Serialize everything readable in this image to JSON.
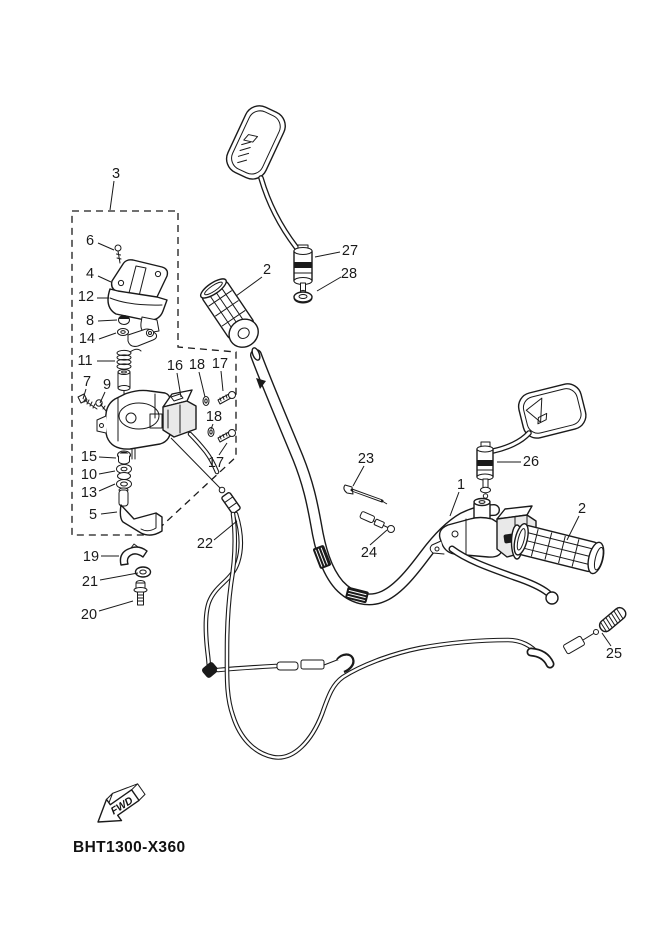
{
  "diagram": {
    "part_code": "BHT1300-X360",
    "fwd_label": "FWD",
    "background": "#ffffff",
    "line_color": "#1a1a1a",
    "callouts": [
      {
        "n": "3",
        "x": 116,
        "y": 178,
        "lx1": 114,
        "ly1": 181,
        "lx2": 110,
        "ly2": 210
      },
      {
        "n": "6",
        "x": 90,
        "y": 245,
        "lx1": 98,
        "ly1": 243,
        "lx2": 114,
        "ly2": 250
      },
      {
        "n": "4",
        "x": 90,
        "y": 278,
        "lx1": 98,
        "ly1": 276,
        "lx2": 111,
        "ly2": 282
      },
      {
        "n": "12",
        "x": 86,
        "y": 301,
        "lx1": 97,
        "ly1": 298,
        "lx2": 109,
        "ly2": 298
      },
      {
        "n": "8",
        "x": 90,
        "y": 325,
        "lx1": 98,
        "ly1": 321,
        "lx2": 117,
        "ly2": 320
      },
      {
        "n": "14",
        "x": 87,
        "y": 343,
        "lx1": 99,
        "ly1": 339,
        "lx2": 116,
        "ly2": 333
      },
      {
        "n": "11",
        "x": 85,
        "y": 365,
        "lx1": 97,
        "ly1": 361,
        "lx2": 115,
        "ly2": 361
      },
      {
        "n": "7",
        "x": 87,
        "y": 386,
        "lx1": 86,
        "ly1": 389,
        "lx2": 83,
        "ly2": 399
      },
      {
        "n": "9",
        "x": 107,
        "y": 389,
        "lx1": 105,
        "ly1": 392,
        "lx2": 100,
        "ly2": 403
      },
      {
        "n": "16",
        "x": 175,
        "y": 370,
        "lx1": 177,
        "ly1": 373,
        "lx2": 181,
        "ly2": 397
      },
      {
        "n": "18",
        "x": 197,
        "y": 369,
        "lx1": 199,
        "ly1": 372,
        "lx2": 205,
        "ly2": 397
      },
      {
        "n": "17",
        "x": 220,
        "y": 368,
        "lx1": 221,
        "ly1": 371,
        "lx2": 223,
        "ly2": 391
      },
      {
        "n": "18",
        "x": 214,
        "y": 421,
        "lx1": 213,
        "ly1": 424,
        "lx2": 211,
        "ly2": 429
      },
      {
        "n": "17",
        "x": 216,
        "y": 467,
        "lx1": 219,
        "ly1": 455,
        "lx2": 227,
        "ly2": 443
      },
      {
        "n": "15",
        "x": 89,
        "y": 461,
        "lx1": 99,
        "ly1": 457,
        "lx2": 116,
        "ly2": 458
      },
      {
        "n": "10",
        "x": 89,
        "y": 479,
        "lx1": 99,
        "ly1": 474,
        "lx2": 115,
        "ly2": 471
      },
      {
        "n": "13",
        "x": 89,
        "y": 497,
        "lx1": 99,
        "ly1": 491,
        "lx2": 115,
        "ly2": 484
      },
      {
        "n": "5",
        "x": 93,
        "y": 519,
        "lx1": 101,
        "ly1": 514,
        "lx2": 117,
        "ly2": 512
      },
      {
        "n": "19",
        "x": 91,
        "y": 561,
        "lx1": 101,
        "ly1": 556,
        "lx2": 119,
        "ly2": 556
      },
      {
        "n": "21",
        "x": 90,
        "y": 586,
        "lx1": 100,
        "ly1": 580,
        "lx2": 138,
        "ly2": 573
      },
      {
        "n": "20",
        "x": 89,
        "y": 619,
        "lx1": 99,
        "ly1": 611,
        "lx2": 133,
        "ly2": 601
      },
      {
        "n": "22",
        "x": 205,
        "y": 548,
        "lx1": 214,
        "ly1": 540,
        "lx2": 237,
        "ly2": 521
      },
      {
        "n": "23",
        "x": 366,
        "y": 463,
        "lx1": 364,
        "ly1": 466,
        "lx2": 353,
        "ly2": 486
      },
      {
        "n": "24",
        "x": 369,
        "y": 557,
        "lx1": 370,
        "ly1": 545,
        "lx2": 387,
        "ly2": 530
      },
      {
        "n": "1",
        "x": 461,
        "y": 489,
        "lx1": 459,
        "ly1": 492,
        "lx2": 450,
        "ly2": 516
      },
      {
        "n": "26",
        "x": 531,
        "y": 466,
        "lx1": 521,
        "ly1": 462,
        "lx2": 497,
        "ly2": 462
      },
      {
        "n": "2",
        "x": 582,
        "y": 513,
        "lx1": 579,
        "ly1": 516,
        "lx2": 567,
        "ly2": 540
      },
      {
        "n": "25",
        "x": 614,
        "y": 658,
        "lx1": 611,
        "ly1": 646,
        "lx2": 602,
        "ly2": 633
      },
      {
        "n": "27",
        "x": 350,
        "y": 255,
        "lx1": 340,
        "ly1": 252,
        "lx2": 315,
        "ly2": 257
      },
      {
        "n": "28",
        "x": 349,
        "y": 278,
        "lx1": 341,
        "ly1": 277,
        "lx2": 317,
        "ly2": 291
      },
      {
        "n": "2",
        "x": 267,
        "y": 274,
        "lx1": 262,
        "ly1": 277,
        "lx2": 236,
        "ly2": 296
      }
    ]
  }
}
